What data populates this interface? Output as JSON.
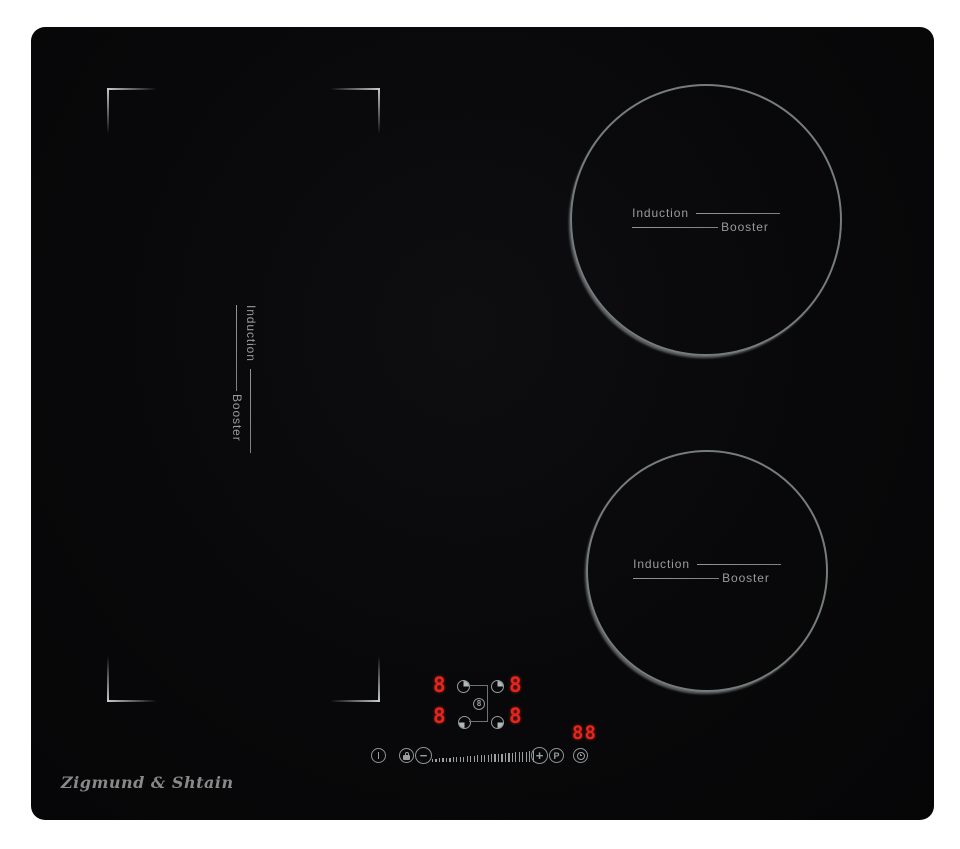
{
  "window": {
    "width": 960,
    "height": 849,
    "background": "#ffffff"
  },
  "cooktop": {
    "brand_logo": "Zigmund & Shtain",
    "surface_color": "#08080a",
    "accent_red": "#e6251c",
    "line_gray": "#9aa0a0",
    "zones": {
      "left_flex": {
        "label_top": "Induction",
        "label_bottom": "Booster"
      },
      "right_top": {
        "label_top": "Induction",
        "label_bottom": "Booster"
      },
      "right_bottom": {
        "label_top": "Induction",
        "label_bottom": "Booster"
      }
    },
    "control_panel": {
      "zone_displays": [
        {
          "position": "left-top",
          "value": "8"
        },
        {
          "position": "right-top",
          "value": "8"
        },
        {
          "position": "left-bottom",
          "value": "8"
        },
        {
          "position": "right-bottom",
          "value": "8"
        }
      ],
      "zone_select_keys": [
        {
          "position": "left-top",
          "filled_quadrant": "top-right"
        },
        {
          "position": "right-top",
          "filled_quadrant": "top-right"
        },
        {
          "position": "left-bottom",
          "filled_quadrant": "bottom-left"
        },
        {
          "position": "right-bottom",
          "filled_quadrant": "bottom-right"
        }
      ],
      "center_indicator_value": "8",
      "timer_display": "88",
      "buttons": {
        "power_icon": "power-standby",
        "lock_icon": "child-lock",
        "minus_label": "−",
        "plus_label": "+",
        "booster_label": "P",
        "timer_icon": "timer-clock"
      },
      "slider_tick_count": 30
    }
  }
}
